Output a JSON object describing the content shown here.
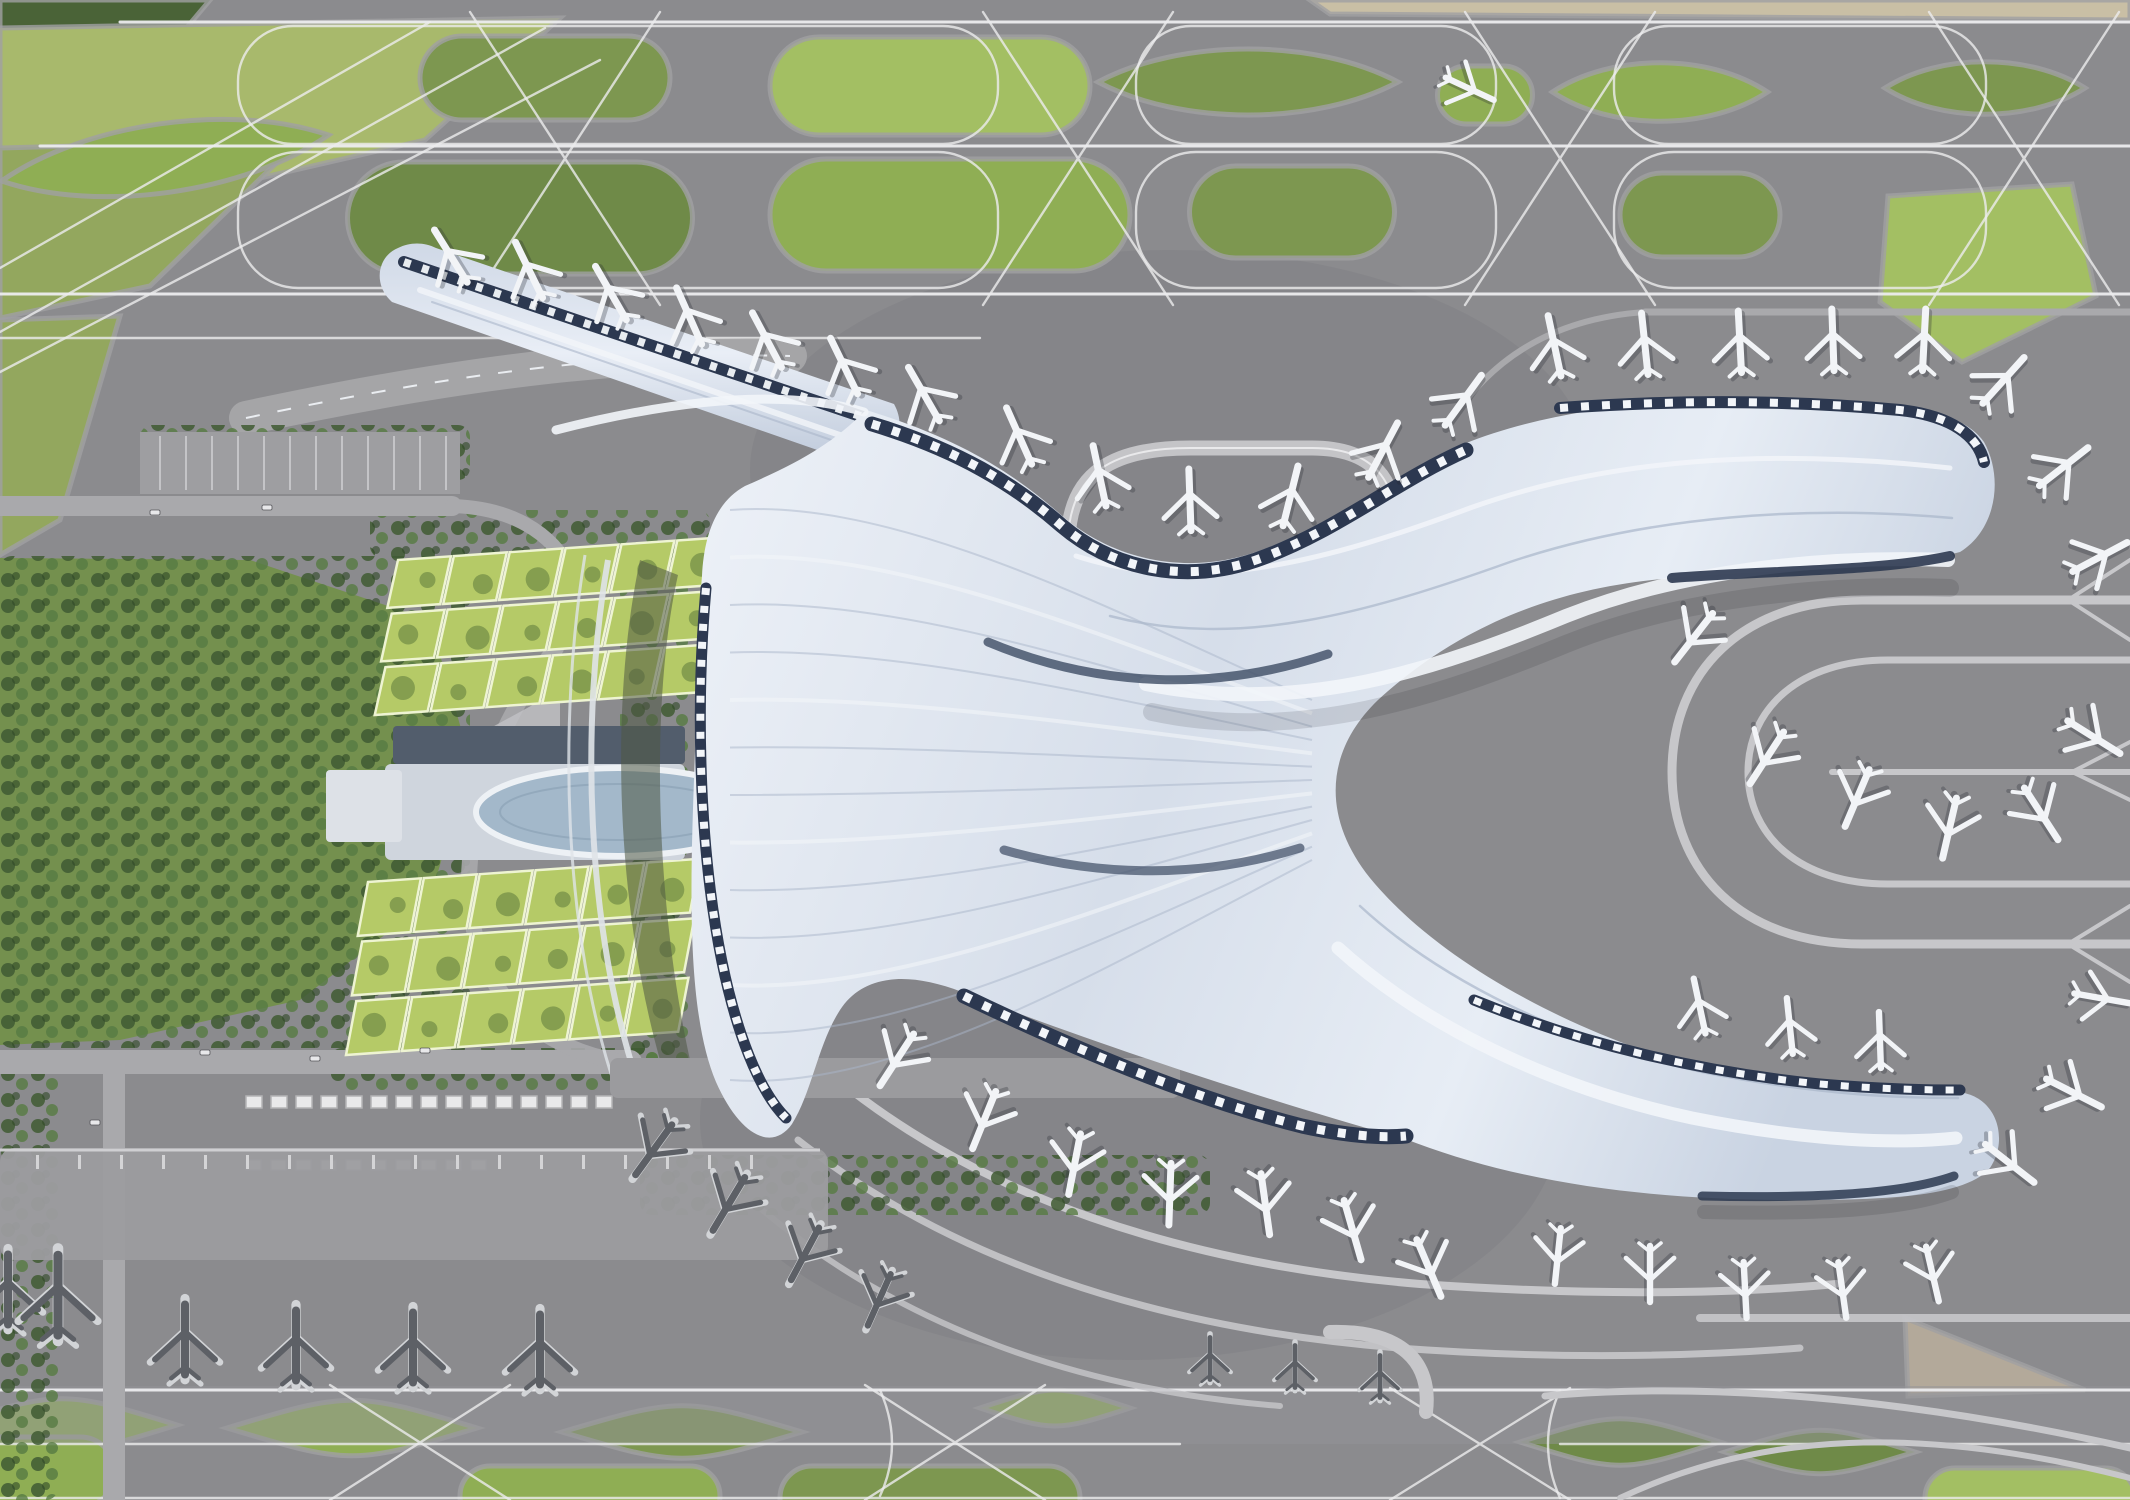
{
  "scene": {
    "description": "Aerial top-down 3D architectural rendering of an airport masterplan: flowing white terminal with curved piers, parked aircraft, taxiway network with green islands, green-roof parking structures and landside park",
    "visible_text": []
  },
  "colors": {
    "base": "#8b8b8e",
    "apron_dark": "#7e7e82",
    "apron_light": "#9c9c9f",
    "line": "#ececee",
    "line_soft": "#c7c7ca",
    "road": "#a9a9ac",
    "navy": "#2c3850",
    "navy_soft": "#3d4c64",
    "roof_hi": "#f2f5f9",
    "roof": "#dde4ee",
    "roof_mid": "#c6d0e0",
    "roof_shade": "#aab6ca",
    "olive1": "#7d9750",
    "olive2": "#8fae54",
    "olive3": "#6f8a48",
    "bright": "#a3bf63",
    "meadow": "#a8b96c",
    "meadow2": "#93a75e",
    "forest": "#4a6337",
    "park": "#74904e",
    "tree": "#3f5a33",
    "cell": "#b5ca67",
    "cell_line": "#eef4d2",
    "cell_blob": "#5d7a3c",
    "pond": "#a3b8ca",
    "building": "#cfd5dd",
    "building_roof": "#525d6c",
    "beige": "#c9bfa5",
    "tan": "#b3a99a",
    "plane_white": "#f2f4f7",
    "plane_dark": "#5d6066",
    "plane_edge": "#d2d4d7",
    "plane_shadow": "#23262e",
    "shed": "#e9e9ea",
    "shed_edge": "#b4b4b6"
  },
  "aircraft_format": "[x, y, rotation_deg, scale(optional, default 2.2), tone(optional: white|dark)]",
  "aircraft": [
    [
      452,
      258,
      -32
    ],
    [
      530,
      272,
      -26
    ],
    [
      612,
      295,
      -30
    ],
    [
      690,
      318,
      -24
    ],
    [
      768,
      342,
      -28
    ],
    [
      845,
      368,
      -26
    ],
    [
      925,
      396,
      -30
    ],
    [
      1020,
      438,
      -24
    ],
    [
      1100,
      478,
      -12
    ],
    [
      1190,
      502,
      -2
    ],
    [
      1290,
      498,
      14
    ],
    [
      1382,
      452,
      28
    ],
    [
      1462,
      402,
      36
    ],
    [
      1555,
      348,
      -12
    ],
    [
      1645,
      346,
      -6
    ],
    [
      1740,
      344,
      -3
    ],
    [
      1833,
      342,
      -2
    ],
    [
      1924,
      342,
      3
    ],
    [
      2002,
      382,
      42
    ],
    [
      2062,
      468,
      52
    ],
    [
      2098,
      558,
      62
    ],
    [
      1695,
      636,
      218
    ],
    [
      1768,
      756,
      213
    ],
    [
      1858,
      796,
      203
    ],
    [
      1950,
      826,
      193
    ],
    [
      2040,
      812,
      147
    ],
    [
      2092,
      736,
      122
    ],
    [
      1468,
      88,
      115,
      1.9
    ],
    [
      898,
      1058,
      213
    ],
    [
      985,
      1118,
      202
    ],
    [
      1075,
      1162,
      191
    ],
    [
      1170,
      1192,
      182
    ],
    [
      1265,
      1202,
      172
    ],
    [
      1352,
      1228,
      164
    ],
    [
      1428,
      1266,
      157
    ],
    [
      1700,
      1008,
      -12,
      2.0
    ],
    [
      1790,
      1028,
      -6,
      2.0
    ],
    [
      1880,
      1042,
      -2,
      2.0
    ],
    [
      2008,
      1162,
      128
    ],
    [
      2072,
      1092,
      117
    ],
    [
      2100,
      998,
      100,
      2.0
    ],
    [
      1558,
      1254,
      186,
      2.0
    ],
    [
      1650,
      1272,
      180,
      2.0
    ],
    [
      1745,
      1288,
      177,
      2.0
    ],
    [
      1842,
      1288,
      172,
      2.0
    ],
    [
      1932,
      1272,
      167,
      2.0
    ],
    [
      655,
      1148,
      216,
      2.2,
      "dark"
    ],
    [
      730,
      1202,
      211,
      2.2,
      "dark"
    ],
    [
      806,
      1252,
      208,
      2.1,
      "dark"
    ],
    [
      880,
      1298,
      204,
      2.0,
      "dark"
    ],
    [
      8,
      1292,
      0,
      2.5,
      "dark"
    ],
    [
      58,
      1298,
      0,
      2.85,
      "dark"
    ],
    [
      185,
      1342,
      0,
      2.5,
      "dark"
    ],
    [
      296,
      1348,
      0,
      2.5,
      "dark"
    ],
    [
      413,
      1350,
      0,
      2.5,
      "dark"
    ],
    [
      540,
      1352,
      0,
      2.5,
      "dark"
    ],
    [
      1210,
      1360,
      0,
      1.5,
      "dark"
    ],
    [
      1295,
      1368,
      0,
      1.5,
      "dark"
    ],
    [
      1380,
      1378,
      0,
      1.5,
      "dark"
    ]
  ],
  "islands_format": "k: lens|round|diamond|poly, f: fill color key",
  "islands": [
    {
      "k": "poly",
      "pts": "0,0 210,0 130,95 0,150",
      "f": "forest"
    },
    {
      "k": "poly",
      "pts": "0,28 560,18 425,140 0,238",
      "f": "meadow"
    },
    {
      "k": "poly",
      "pts": "0,148 300,140 150,286 0,318",
      "f": "meadow2"
    },
    {
      "k": "poly",
      "pts": "0,320 120,316 60,520 0,555",
      "f": "meadow2"
    },
    {
      "k": "poly",
      "pts": "1310,0 2130,0 2130,20 1330,14",
      "f": "beige"
    },
    {
      "k": "poly",
      "pts": "1905,1318 2085,1390 1908,1396",
      "f": "tan"
    },
    {
      "k": "lens",
      "x": 165,
      "y": 158,
      "w": 330,
      "h": 92,
      "rot": -8,
      "f": "olive2"
    },
    {
      "k": "round",
      "x": 545,
      "y": 78,
      "w": 250,
      "h": 84,
      "f": "olive1"
    },
    {
      "k": "round",
      "x": 930,
      "y": 86,
      "w": 320,
      "h": 98,
      "f": "bright"
    },
    {
      "k": "lens",
      "x": 1248,
      "y": 82,
      "w": 300,
      "h": 88,
      "f": "olive1"
    },
    {
      "k": "round",
      "x": 1485,
      "y": 95,
      "w": 95,
      "h": 58,
      "f": "olive2"
    },
    {
      "k": "lens",
      "x": 1660,
      "y": 92,
      "w": 215,
      "h": 78,
      "f": "olive2"
    },
    {
      "k": "lens",
      "x": 1985,
      "y": 88,
      "w": 200,
      "h": 70,
      "f": "olive1"
    },
    {
      "k": "round",
      "x": 520,
      "y": 218,
      "w": 345,
      "h": 112,
      "f": "olive3"
    },
    {
      "k": "round",
      "x": 950,
      "y": 215,
      "w": 360,
      "h": 112,
      "f": "olive2"
    },
    {
      "k": "round",
      "x": 1292,
      "y": 212,
      "w": 205,
      "h": 92,
      "f": "olive1"
    },
    {
      "k": "round",
      "x": 1700,
      "y": 215,
      "w": 160,
      "h": 84,
      "f": "olive1"
    },
    {
      "k": "poly",
      "pts": "1888,196 2072,184 2096,296 1962,362 1880,302",
      "f": "bright"
    },
    {
      "k": "diamond",
      "x": 62,
      "y": 1425,
      "w": 230,
      "h": 70,
      "f": "olive2"
    },
    {
      "k": "diamond",
      "x": 352,
      "y": 1428,
      "w": 250,
      "h": 74,
      "f": "olive2"
    },
    {
      "k": "diamond",
      "x": 682,
      "y": 1432,
      "w": 240,
      "h": 70,
      "f": "olive1"
    },
    {
      "k": "diamond",
      "x": 1055,
      "y": 1408,
      "w": 150,
      "h": 48,
      "f": "olive2"
    },
    {
      "k": "diamond",
      "x": 1620,
      "y": 1442,
      "w": 200,
      "h": 62,
      "f": "olive3"
    },
    {
      "k": "diamond",
      "x": 1820,
      "y": 1452,
      "w": 190,
      "h": 58,
      "f": "olive3"
    },
    {
      "k": "round",
      "x": 590,
      "y": 1496,
      "w": 260,
      "h": 60,
      "f": "olive2"
    },
    {
      "k": "round",
      "x": 930,
      "y": 1498,
      "w": 300,
      "h": 64,
      "f": "olive1"
    },
    {
      "k": "round",
      "x": 2030,
      "y": 1498,
      "w": 210,
      "h": 60,
      "f": "bright"
    },
    {
      "k": "round",
      "x": 30,
      "y": 1472,
      "w": 170,
      "h": 70,
      "f": "olive2"
    }
  ],
  "parking_structures": [
    {
      "x": 398,
      "y": 560,
      "rows": 3,
      "cols": 6,
      "cw": 56,
      "ch": 50,
      "lean": 14,
      "rot": -4
    },
    {
      "x": 368,
      "y": 882,
      "rows": 3,
      "cols": 6,
      "cw": 56,
      "ch": 56,
      "lean": 14,
      "rot": -4
    }
  ],
  "shed_rows": [
    {
      "x0": 246,
      "y": 1096,
      "count": 15,
      "step": 25,
      "w": 16,
      "h": 12
    },
    {
      "x0": 246,
      "y": 1160,
      "count": 10,
      "step": 25,
      "w": 15,
      "h": 10
    }
  ],
  "tree_patches": [
    {
      "x": 0,
      "y": 556,
      "w": 470,
      "h": 492
    },
    {
      "x": 140,
      "y": 425,
      "w": 330,
      "h": 55
    },
    {
      "x": 640,
      "y": 1155,
      "w": 570,
      "h": 60
    },
    {
      "x": 0,
      "y": 1055,
      "w": 58,
      "h": 445
    },
    {
      "x": 370,
      "y": 510,
      "w": 340,
      "h": 48
    },
    {
      "x": 330,
      "y": 1048,
      "w": 340,
      "h": 42
    },
    {
      "x": 620,
      "y": 556,
      "w": 70,
      "h": 520
    }
  ],
  "cars": [
    [
      200,
      1050
    ],
    [
      310,
      1056
    ],
    [
      420,
      1048
    ],
    [
      150,
      510
    ],
    [
      262,
      505
    ],
    [
      90,
      1120
    ]
  ],
  "terminal": {
    "ripples": {
      "count": 13,
      "x_start": 730,
      "y_top": 510,
      "y_bottom": 1080,
      "x_end": 1312,
      "y_end_top": 700,
      "y_end_bottom": 860
    }
  }
}
